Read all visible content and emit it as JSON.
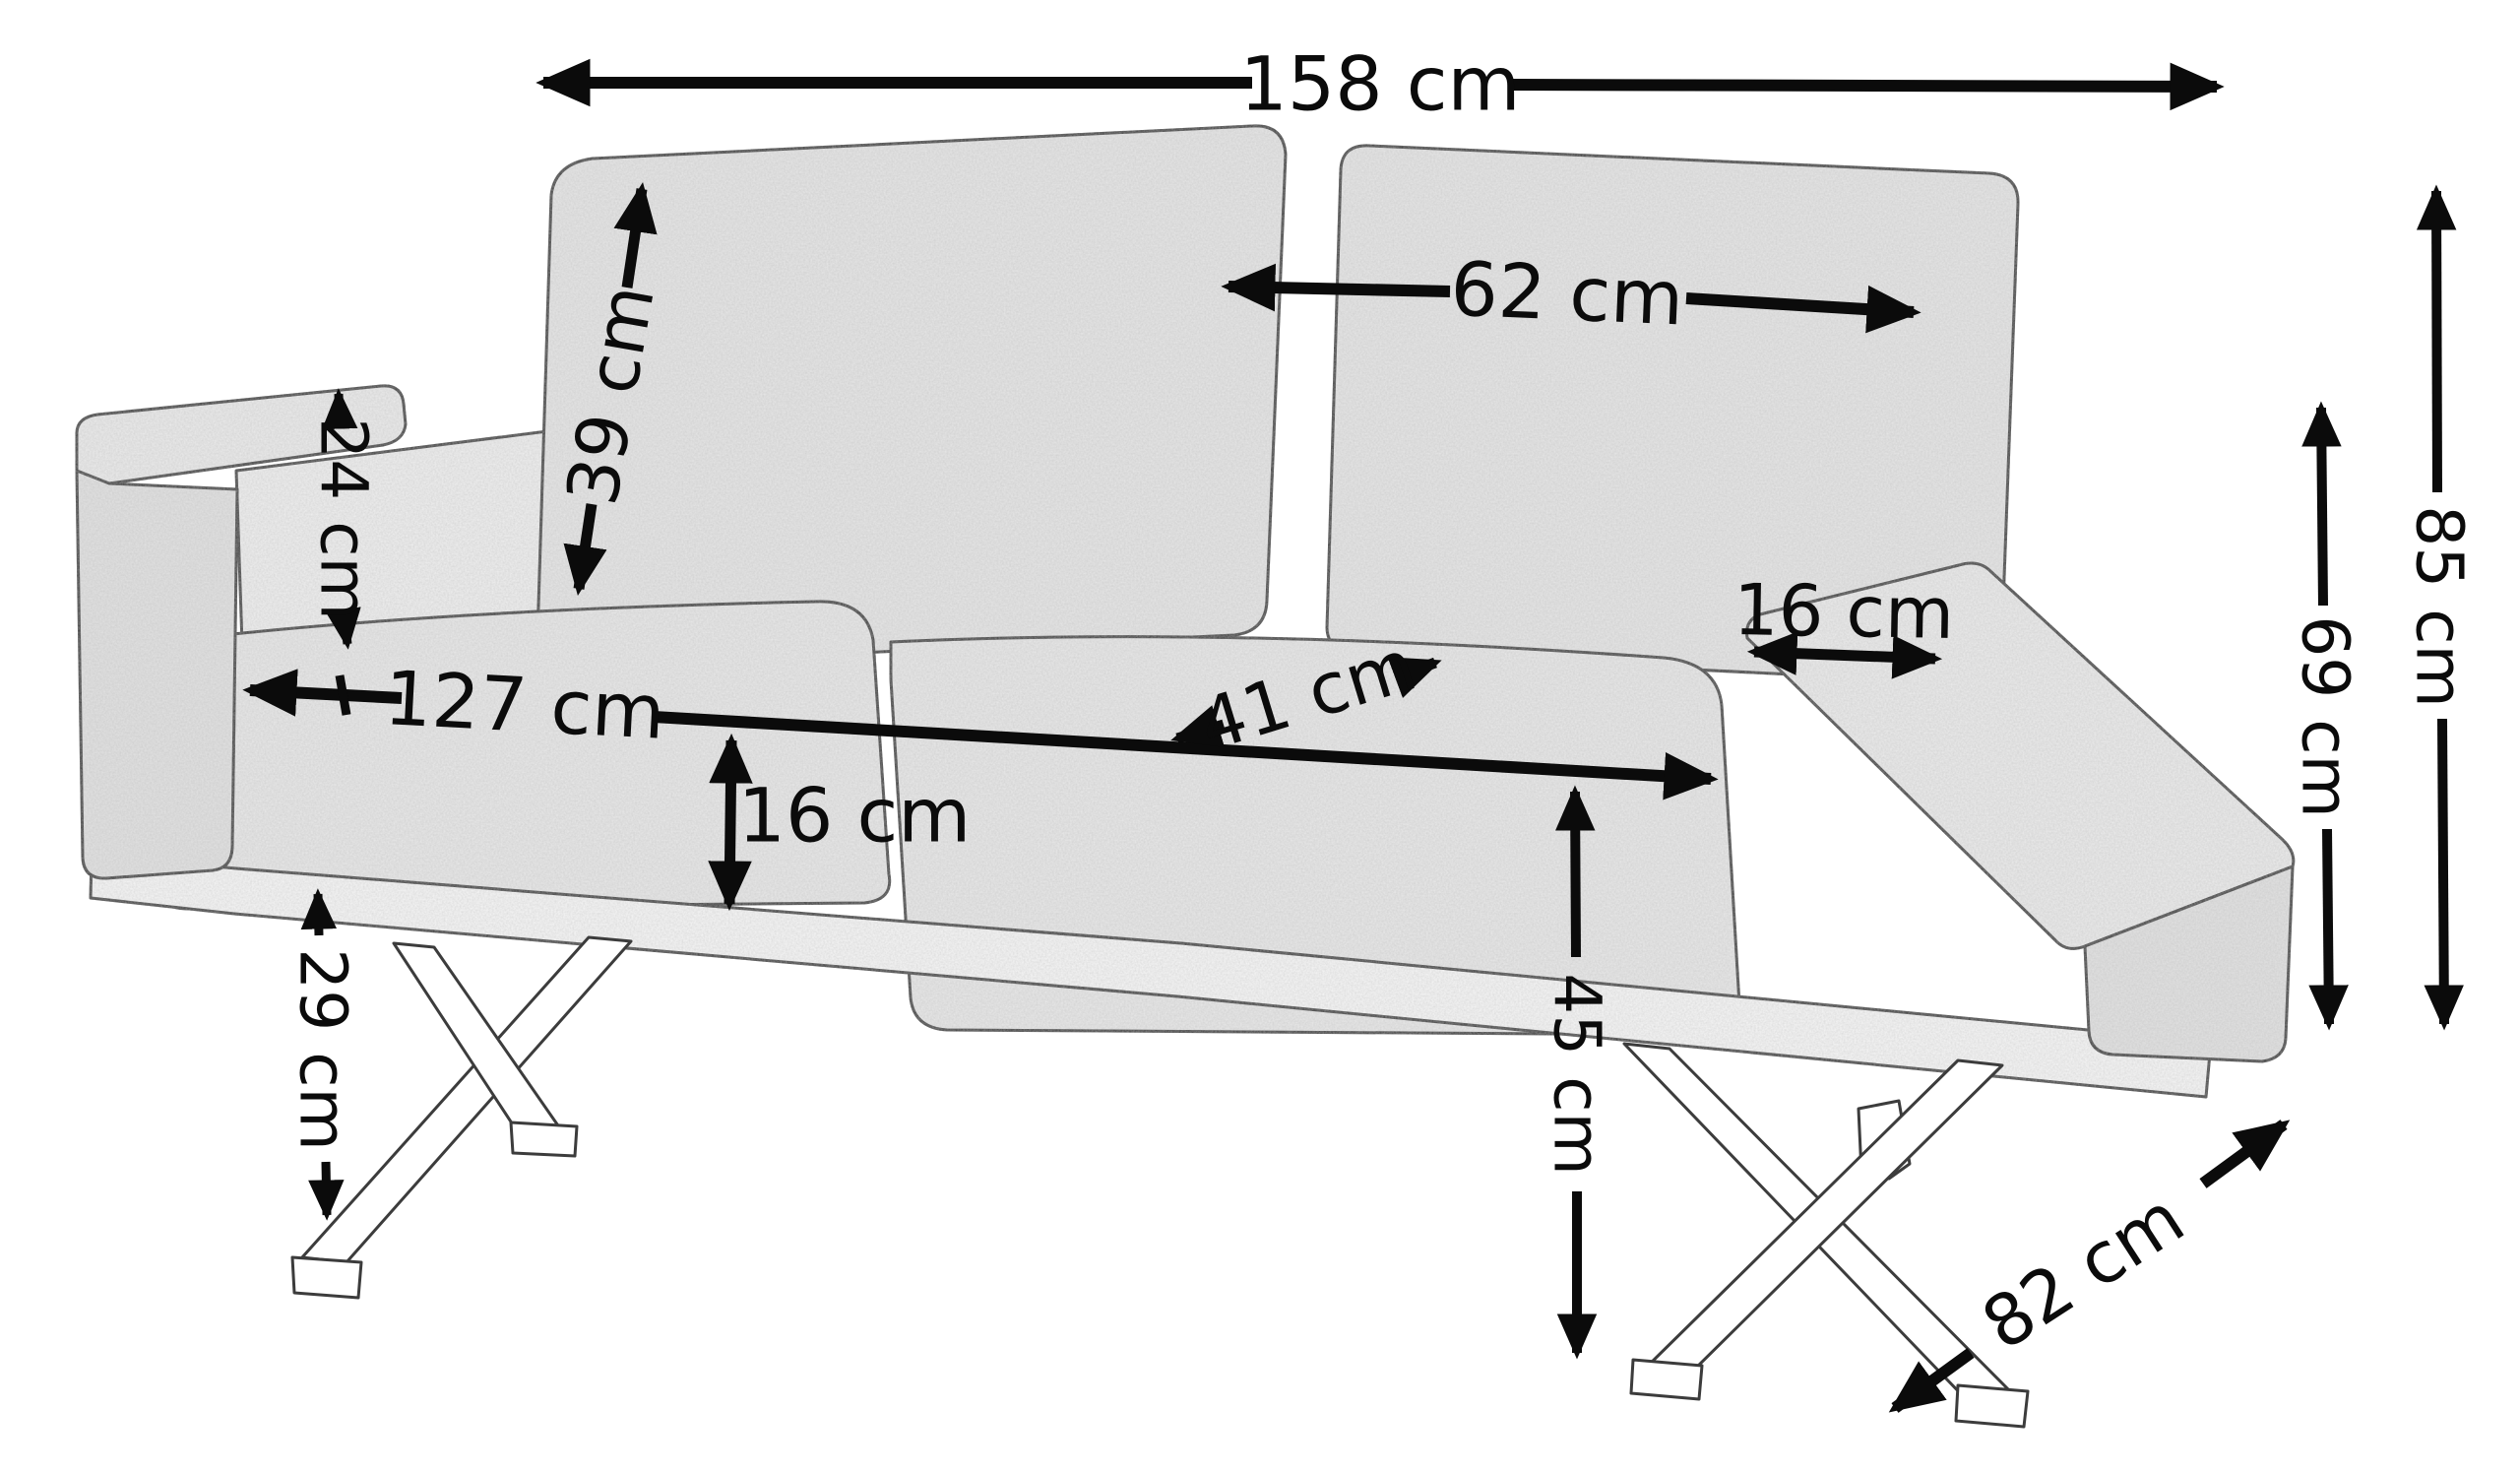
{
  "figure": {
    "type": "product-dimension-diagram",
    "subject": "two-seat upholstered sofa on crossed metal legs, three-quarter view line drawing",
    "background_color": "#ffffff",
    "annotation_color": "#0b0b0b",
    "fabric_color": "#e7e7e7",
    "outline_color": "#3c3c3c",
    "unit": "cm"
  },
  "dims": {
    "overall_width": {
      "label": "158 cm",
      "orientation": "horizontal",
      "position": "top"
    },
    "back_cushion_width": {
      "label": "62 cm",
      "orientation": "horizontal",
      "position": "right-back-cushion"
    },
    "back_cushion_height": {
      "label": "39 cm",
      "orientation": "diagonal-vertical",
      "position": "left-back-cushion"
    },
    "armrest_to_seat": {
      "label": "24 cm",
      "orientation": "vertical",
      "position": "left-armrest"
    },
    "seat_width": {
      "label": "127 cm",
      "orientation": "horizontal",
      "position": "seat-front"
    },
    "seat_depth": {
      "label": "41 cm",
      "orientation": "diagonal",
      "position": "seat-top"
    },
    "armrest_top_width": {
      "label": "16 cm",
      "orientation": "horizontal",
      "position": "right-armrest-top"
    },
    "seat_cushion_thickness": {
      "label": "16 cm",
      "orientation": "vertical",
      "position": "seat-front-face"
    },
    "leg_height": {
      "label": "29 cm",
      "orientation": "vertical",
      "position": "bottom-left"
    },
    "seat_height": {
      "label": "45 cm",
      "orientation": "vertical",
      "position": "front-right-leg"
    },
    "armrest_height": {
      "label": "69 cm",
      "orientation": "vertical",
      "position": "right-margin-inner"
    },
    "overall_height": {
      "label": "85 cm",
      "orientation": "vertical",
      "position": "right-margin-outer"
    },
    "overall_depth": {
      "label": "82 cm",
      "orientation": "diagonal",
      "position": "bottom-right"
    }
  }
}
